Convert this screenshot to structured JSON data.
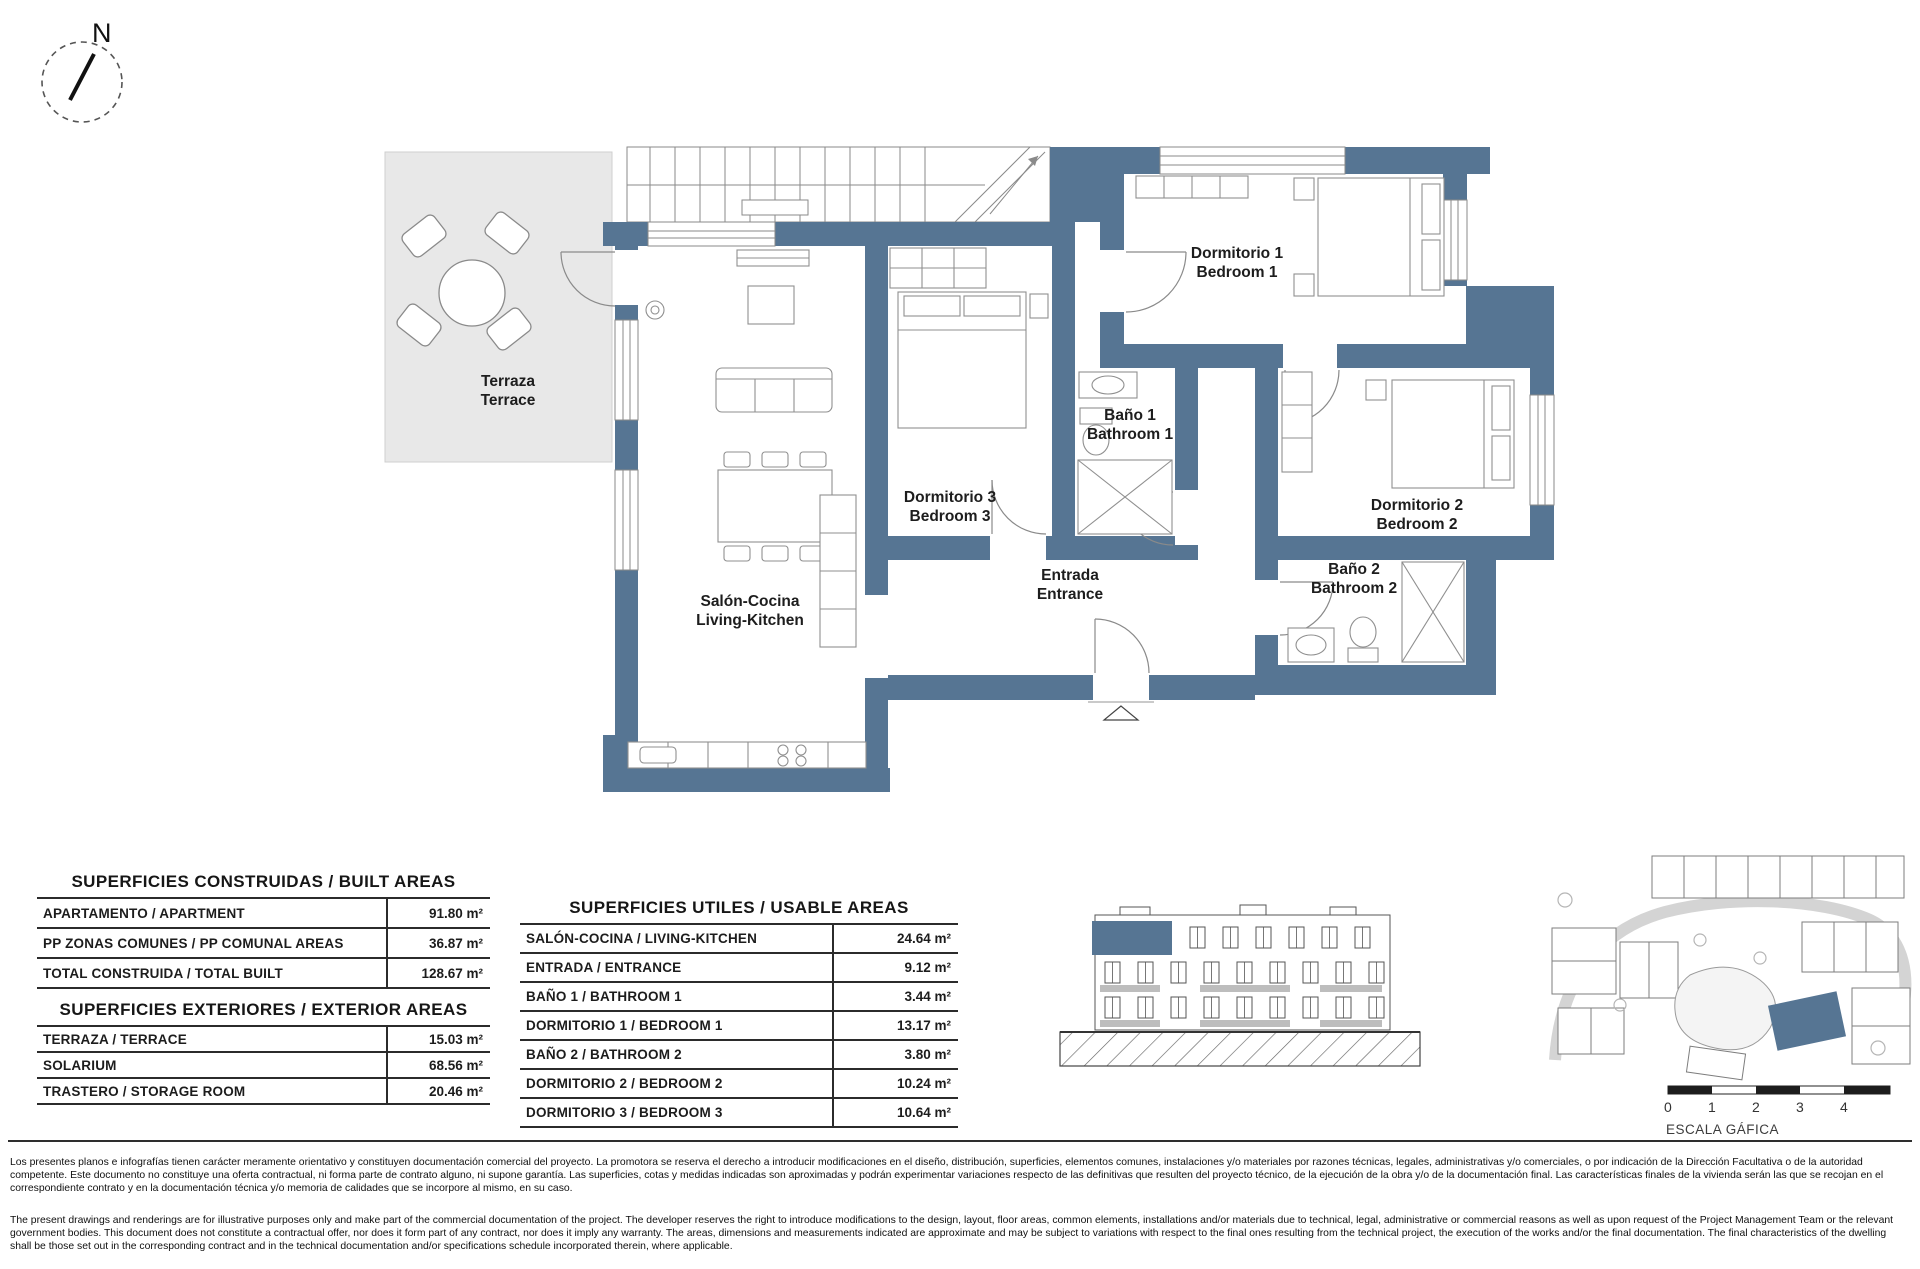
{
  "page": {
    "compass_label": "N",
    "scale": {
      "label": "ESCALA GÁFICA",
      "ticks": [
        "0",
        "1",
        "2",
        "3",
        "4"
      ]
    }
  },
  "colors": {
    "wall": "#567593",
    "terrace": "#e8e8e8",
    "highlight_unit": "#567593"
  },
  "plan": {
    "rooms": {
      "terraza": {
        "line1": "Terraza",
        "line2": "Terrace"
      },
      "dormitorio1": {
        "line1": "Dormitorio 1",
        "line2": "Bedroom 1"
      },
      "bano1": {
        "line1": "Baño 1",
        "line2": "Bathroom 1"
      },
      "dormitorio3": {
        "line1": "Dormitorio 3",
        "line2": "Bedroom 3"
      },
      "dormitorio2": {
        "line1": "Dormitorio 2",
        "line2": "Bedroom 2"
      },
      "bano2": {
        "line1": "Baño 2",
        "line2": "Bathroom 2"
      },
      "entrada": {
        "line1": "Entrada",
        "line2": "Entrance"
      },
      "salon": {
        "line1": "Salón-Cocina",
        "line2": "Living-Kitchen"
      }
    }
  },
  "tables": {
    "built": {
      "title": "SUPERFICIES CONSTRUIDAS / BUILT AREAS",
      "rows": [
        {
          "label": "APARTAMENTO / APARTMENT",
          "value": "91.80 m²"
        },
        {
          "label": "PP ZONAS COMUNES / PP COMUNAL AREAS",
          "value": "36.87 m²"
        },
        {
          "label": "TOTAL CONSTRUIDA / TOTAL BUILT",
          "value": "128.67 m²"
        }
      ]
    },
    "exterior": {
      "title": "SUPERFICIES EXTERIORES / EXTERIOR AREAS",
      "rows": [
        {
          "label": "TERRAZA / TERRACE",
          "value": "15.03 m²"
        },
        {
          "label": "SOLARIUM",
          "value": "68.56 m²"
        },
        {
          "label": "TRASTERO / STORAGE ROOM",
          "value": "20.46 m²"
        }
      ]
    },
    "usable": {
      "title": "SUPERFICIES UTILES / USABLE AREAS",
      "rows": [
        {
          "label": "SALÓN-COCINA / LIVING-KITCHEN",
          "value": "24.64 m²"
        },
        {
          "label": "ENTRADA / ENTRANCE",
          "value": "9.12 m²"
        },
        {
          "label": "BAÑO 1 / BATHROOM 1",
          "value": "3.44 m²"
        },
        {
          "label": "DORMITORIO 1 / BEDROOM 1",
          "value": "13.17 m²"
        },
        {
          "label": "BAÑO 2 / BATHROOM 2",
          "value": "3.80 m²"
        },
        {
          "label": "DORMITORIO 2 / BEDROOM 2",
          "value": "10.24 m²"
        },
        {
          "label": "DORMITORIO 3 / BEDROOM 3",
          "value": "10.64 m²"
        }
      ]
    }
  },
  "disclaimer": {
    "es": "Los presentes planos e infografías tienen carácter meramente orientativo y constituyen documentación comercial del proyecto. La promotora se reserva el derecho a introducir modificaciones en el diseño, distribución, superficies, elementos comunes, instalaciones y/o materiales por razones técnicas, legales, administrativas y/o comerciales, o por indicación de la Dirección Facultativa o de la autoridad competente. Este documento no constituye una oferta contractual, ni forma parte de contrato alguno, ni supone garantía. Las superficies, cotas y medidas indicadas son aproximadas y podrán experimentar variaciones respecto de las definitivas que resulten del proyecto técnico, de la ejecución de la obra y/o de la documentación final. Las características finales de la vivienda serán las que se recojan en el correspondiente contrato y en la documentación técnica y/o memoria de calidades que se incorpore al mismo, en su caso.",
    "en": "The present drawings and renderings are for illustrative purposes only and make part of the commercial documentation of the project. The developer reserves the right to introduce modifications to the design, layout, floor areas, common elements, installations and/or materials due to technical, legal, administrative or commercial reasons as well as upon request of the Project Management Team or the relevant government bodies. This document does not constitute a contractual offer, nor does it form part of any contract, nor does it imply any warranty. The areas, dimensions and measurements indicated are approximate and may be subject to variations with respect to the final ones resulting from the technical project, the execution of the works and/or the final documentation. The final characteristics of the dwelling shall be those set out in the corresponding contract and in the technical documentation and/or specifications schedule incorporated therein, where applicable."
  }
}
